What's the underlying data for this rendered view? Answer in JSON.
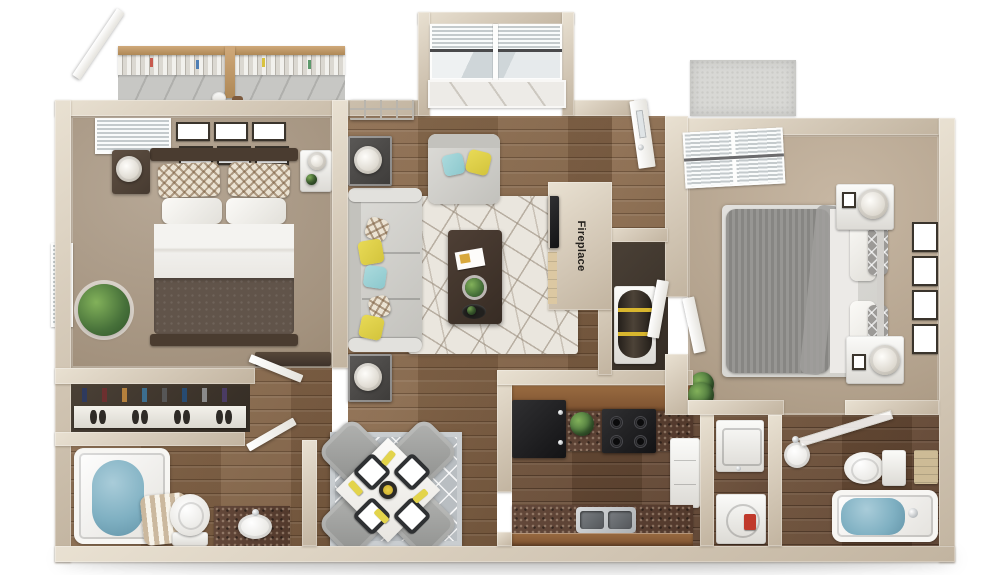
{
  "labels": {
    "fireplace": "Fireplace"
  },
  "palette": {
    "wall": "#d7ccbb",
    "wood_floor": "#85664b",
    "wood_floor_dark": "#6b4f38",
    "carpet_master": "#a3927e",
    "carpet_guest": "#b2a18c",
    "rug_living": "#eae6de",
    "rug_dining": "#b9bec2",
    "sofa_gray": "#d8d7d3",
    "accent_yellow": "#ddcf46",
    "accent_teal": "#9ed2d5",
    "cabinet_wood": "#8a5c38",
    "granite_counter": "#5a4133",
    "appliance_black": "#1d1d1f",
    "water_blue": "#7fb0c2",
    "master_bedding": "#61544a",
    "guest_bedding": "#8f8e8b",
    "deck_concrete": "#c7c7c4",
    "railing_wood": "#c09a6c",
    "label_text": "#24211d"
  }
}
